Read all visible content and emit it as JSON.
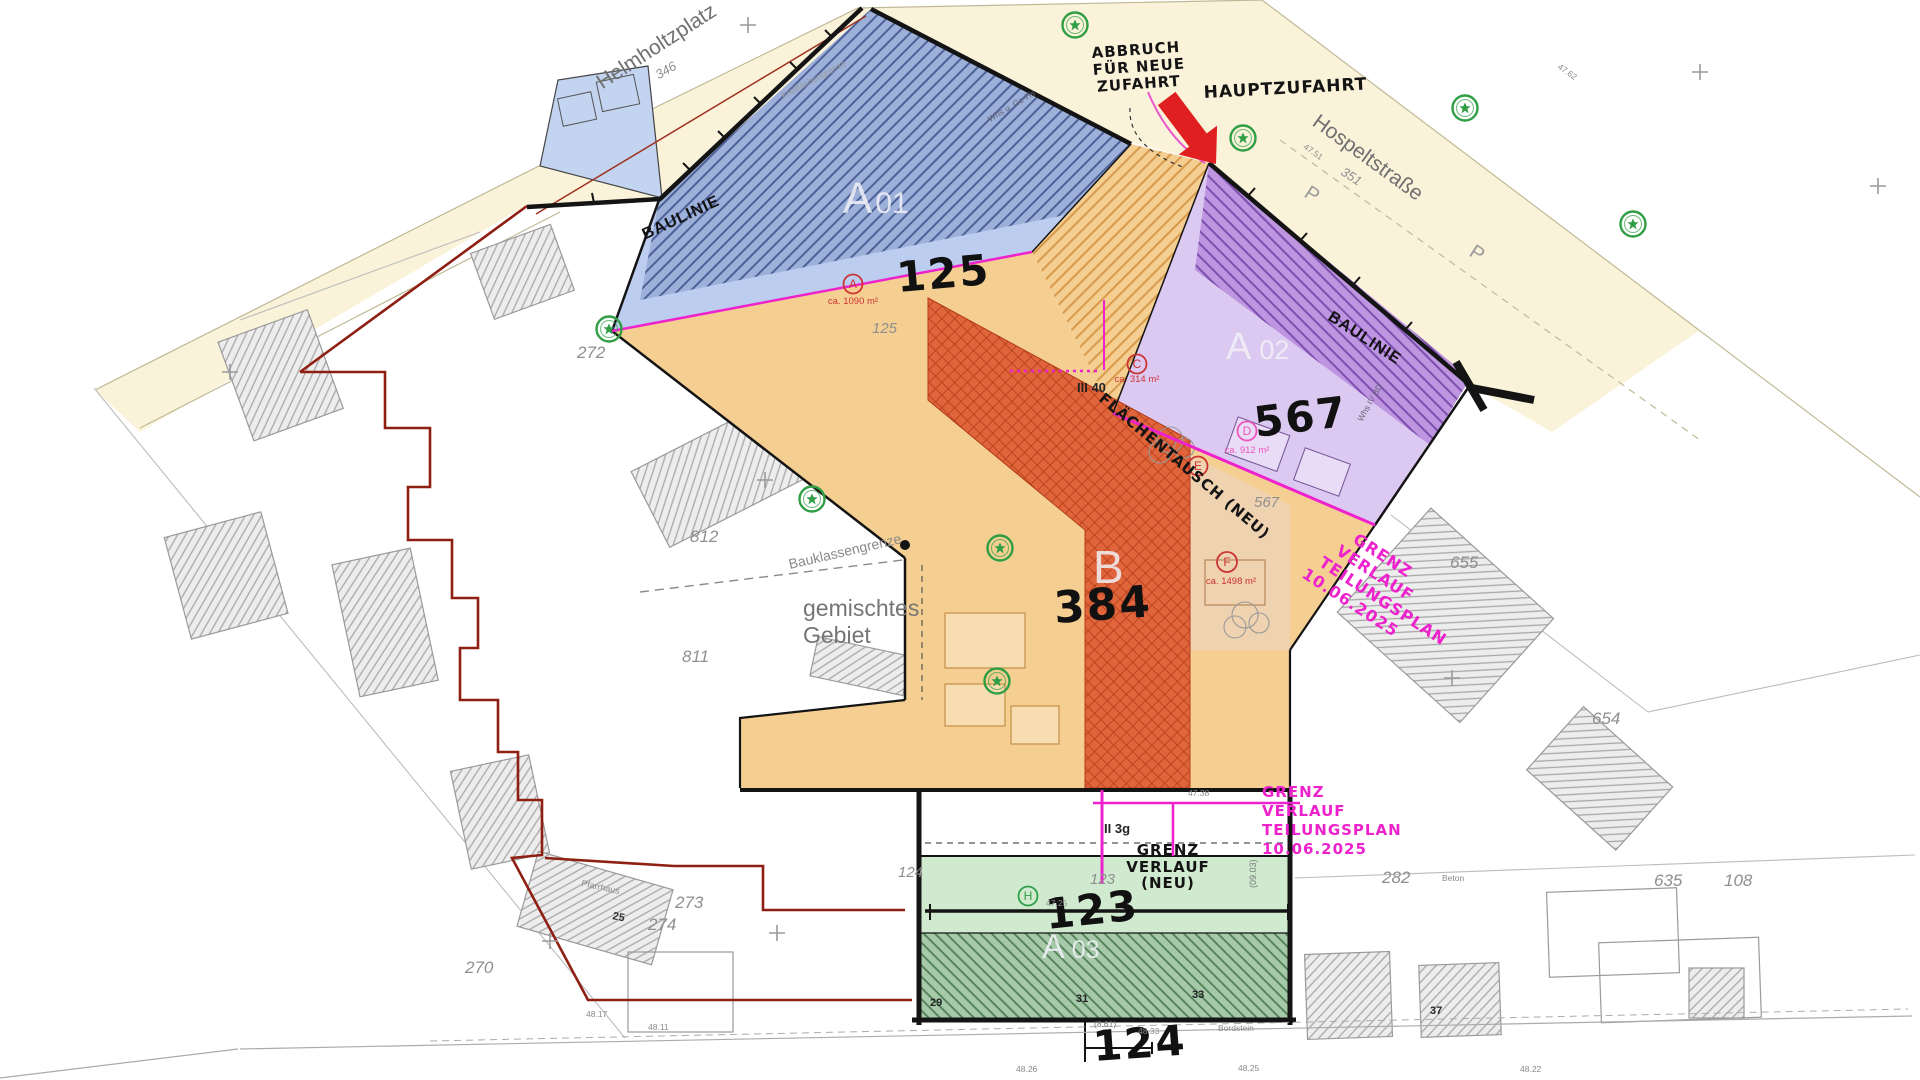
{
  "streets": {
    "helmholtzplatz": "Helmholtzplatz",
    "helmholtzplatz_num": "346",
    "hospeltstrasse": "Hospeltstraße",
    "hospeltstrasse_num": "351",
    "parking": "P"
  },
  "annotations": {
    "abbruch": [
      "ABBRUCH",
      "FÜR NEUE",
      "ZUFAHRT"
    ],
    "hauptzufahrt": "HAUPTZUFAHRT",
    "baulinie": "BAULINIE",
    "flaechentausch": "FLÄCHENTAUSCH (NEU)",
    "grenz_neu": [
      "GRENZ",
      "VERLAUF",
      "(NEU)"
    ],
    "grenz_diag": [
      "GRENZ",
      "VERLAUF",
      "TEILUNGSPLAN",
      "10.06.2025"
    ],
    "grenz_block": [
      "GRENZ",
      "VERLAUF",
      "TEILUNGSPLAN",
      "10.06.2025"
    ],
    "gemischtes": [
      "gemischtes",
      "Gebiet"
    ],
    "bauklassengrenze": "Bauklassengrenze",
    "freiflaechengrenze": "Freiflächengrenze"
  },
  "zones": {
    "a01": {
      "letter": "A",
      "num": "01",
      "value": "125"
    },
    "a02": {
      "letter": "A",
      "num": "02",
      "value": "567"
    },
    "a03": {
      "letter": "A",
      "num": "03",
      "value": "123",
      "value2": "124"
    },
    "b": {
      "letter": "B",
      "value": "384"
    }
  },
  "markers": {
    "a": {
      "letter": "A",
      "area": "ca. 1090 m²"
    },
    "c": {
      "letter": "C",
      "area": "ca. 314 m²"
    },
    "d": {
      "letter": "D",
      "area": "ca. 912 m²"
    },
    "e": {
      "letter": "E"
    },
    "f": {
      "letter": "F",
      "area": "ca. 1498 m²"
    },
    "h": {
      "letter": "H"
    }
  },
  "parcels": {
    "p272": "272",
    "p812": "812",
    "p811": "811",
    "p273": "273",
    "p274": "274",
    "p270": "270",
    "p655": "655",
    "p654": "654",
    "p282": "282",
    "p635": "635",
    "p108": "108",
    "p125": "125",
    "p567": "567",
    "p123": "123",
    "p124": "124"
  },
  "small": {
    "ii3g": "II 3g",
    "iii40": "III 40",
    "pfarrhaus": "Pfarrhaus",
    "n25": "25",
    "n29": "29",
    "n31": "31",
    "n33": "33",
    "n37": "37",
    "whs": "Whs u. Ge-Hs",
    "whs2": "Whs IV BD",
    "bordstein": "Bordstein",
    "beton": "Beton",
    "dim861": "(8.61)",
    "dim0903": "(09.03)"
  },
  "elev": {
    "e1": "48.17",
    "e2": "48.11",
    "e3": "47.25",
    "e4": "47.38",
    "e5": "48.33",
    "e6": "48.26",
    "e7": "47.51",
    "e8": "47.62",
    "e9": "48.25",
    "e10": "48.22"
  },
  "colors": {
    "beige": "#faf3da",
    "blue_light": "#bccdf0",
    "blue_hatch_bg": "#9db0da",
    "blue_hatch_line": "#4d6198",
    "lavender": "#dcc9f1",
    "purple_hatch_bg": "#bd95e0",
    "purple_hatch_line": "#7c4fae",
    "orange": "#f5cf92",
    "orange_hatch_line": "#d89b4e",
    "red_zone": "#e0653a",
    "red_zone_hatch": "#b23a1a",
    "peach": "#efd2b0",
    "green_light": "#cfeacf",
    "green_dark_bg": "#a6c9a9",
    "green_dark_line": "#4f7f55",
    "magenta": "#ee22cc",
    "dark_red_boundary": "#8e1f12",
    "arrow_red": "#e02020",
    "tree_green": "#2f9e44"
  }
}
